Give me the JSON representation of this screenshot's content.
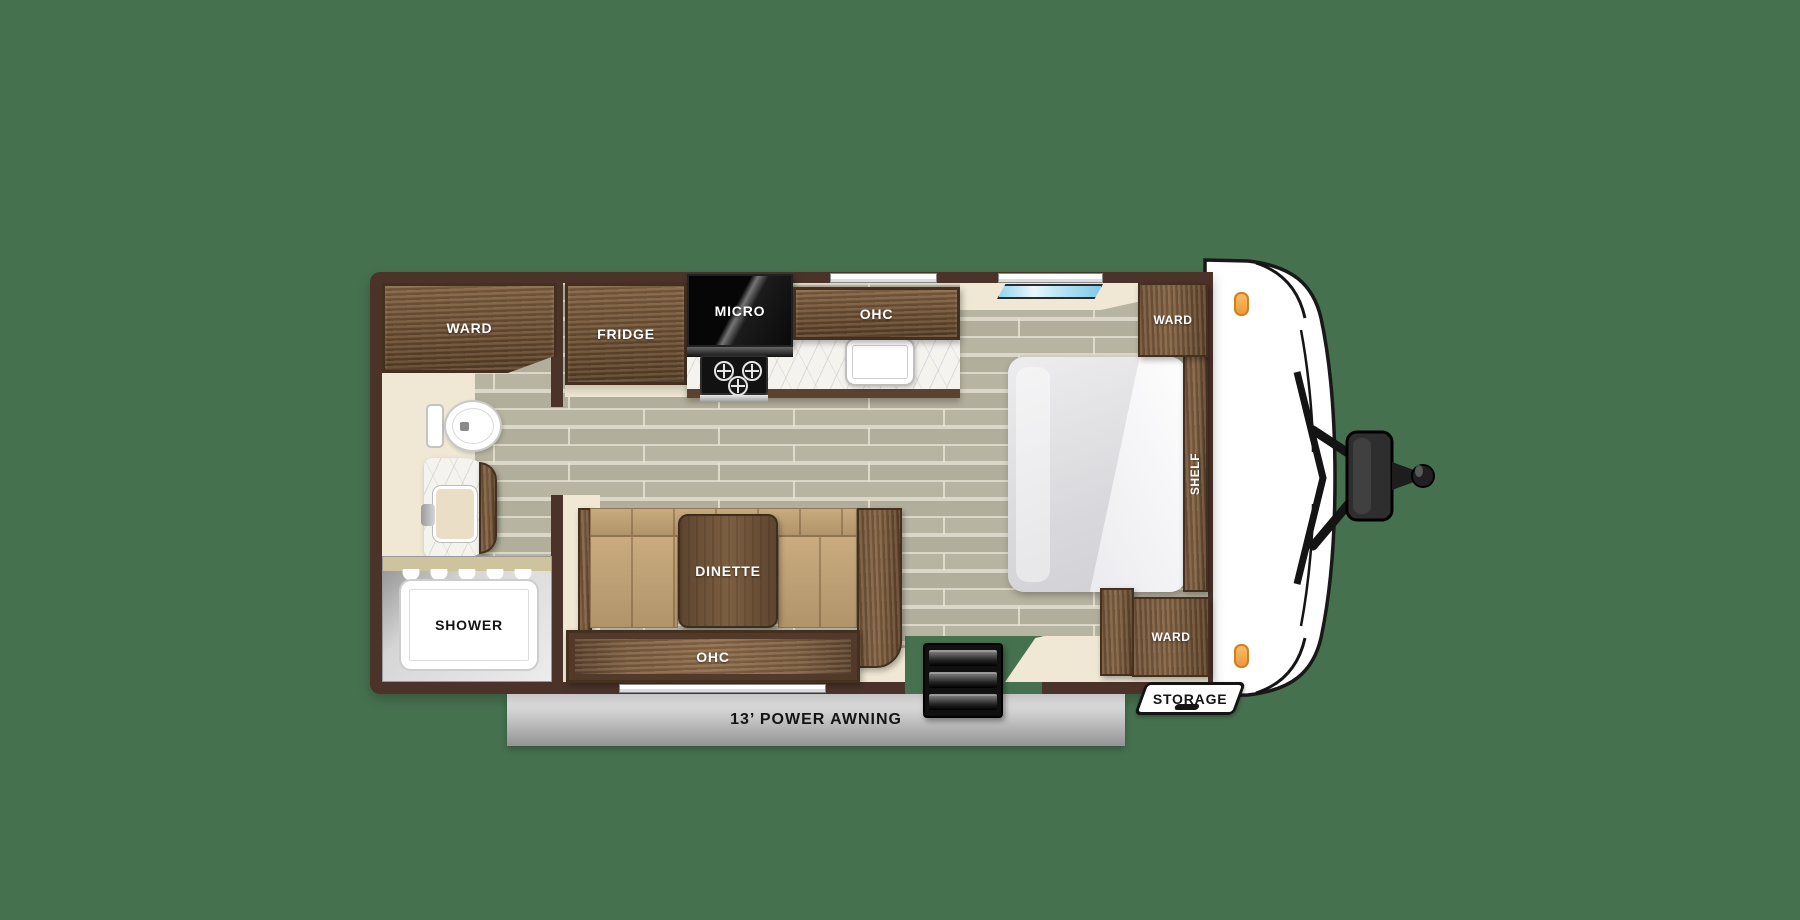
{
  "title": "Travel trailer floor plan",
  "colors": {
    "background": "#46714f",
    "wall": "#4b332a",
    "wood": "#6e5138",
    "wood_dark": "#45301f",
    "floor": "#b5b19f",
    "cream": "#f0e8d4",
    "cushion": "#bfa076",
    "skylight": "#8ed2ee",
    "marker": "#f0a24f"
  },
  "rooms": {
    "bathroom": {
      "ward": "WARD",
      "shower": "SHOWER"
    },
    "kitchen": {
      "fridge": "FRIDGE",
      "micro": "MICRO",
      "ohc": "OHC"
    },
    "dinette": {
      "table": "DINETTE",
      "ohc": "OHC"
    },
    "bedroom": {
      "ward_head": "WARD",
      "ward_foot": "WARD",
      "shelf": "SHELF"
    },
    "exterior": {
      "storage": "STORAGE",
      "awning": "13’ POWER AWNING"
    }
  }
}
